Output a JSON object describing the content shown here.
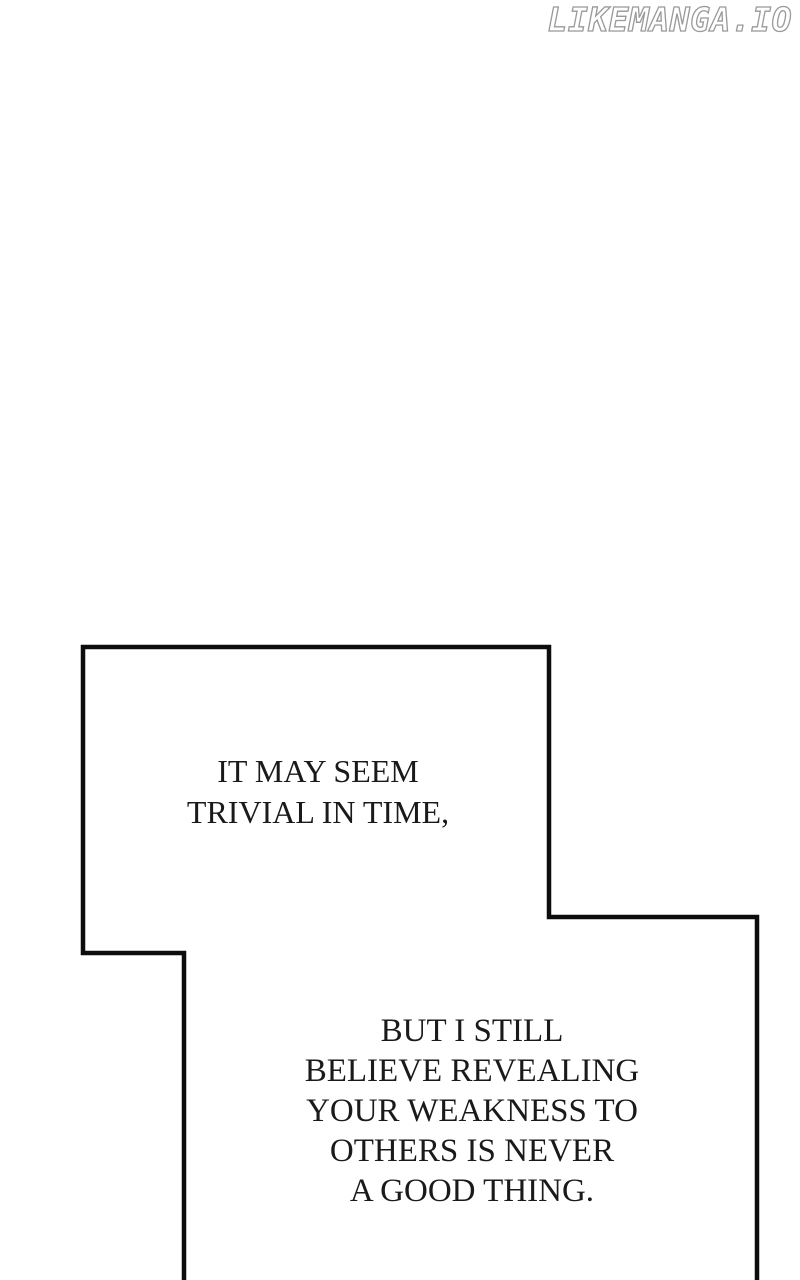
{
  "watermark": {
    "text": "LIKEMANGA.IO"
  },
  "dialogues": [
    {
      "text": "IT MAY SEEM\nTRIVIAL IN TIME,"
    },
    {
      "text": "BUT I STILL\nBELIEVE REVEALING\nYOUR WEAKNESS TO\nOTHERS IS NEVER\nA GOOD THING."
    }
  ],
  "colors": {
    "background": "#ffffff",
    "panel-border": "#0d0d0d",
    "text": "#1a1a1a",
    "watermark-fill": "#ffffff",
    "watermark-outline": "#9a9a9a"
  }
}
